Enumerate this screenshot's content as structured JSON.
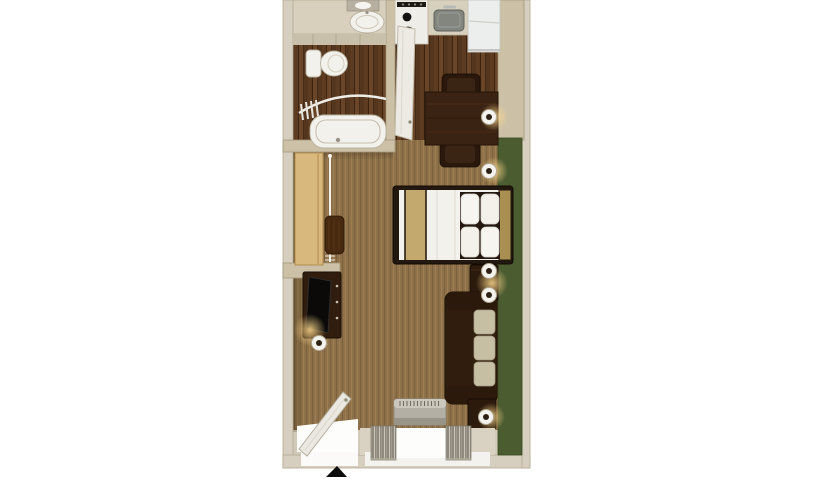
{
  "meta": {
    "type": "floor-plan",
    "view": "top-down-3d-render",
    "subject": "studio-suite-room-layout"
  },
  "rooms": {
    "bathroom": "bathroom",
    "kitchen": "kitchenette",
    "closet": "open-closet",
    "living_area": "combined-sleeping-living-area",
    "entry": "entry"
  },
  "furniture": {
    "vanity": "vanity-counter-with-sink",
    "mirror": "vanity-mirror",
    "toilet": "toilet",
    "bathtub": "bathtub-with-shower-curtain-rod",
    "bathroom_door": "open-bathroom-door",
    "stove": "two-burner-cooktop",
    "kitchen_sink": "kitchen-sink",
    "fridge": "refrigerator",
    "dining_table": "dining-table",
    "chair_top": "dining-chair",
    "chair_bottom": "dining-chair",
    "bed": "double-bed-with-pillows",
    "runner": "gold-bed-runner",
    "headboard": "wood-headboard",
    "nightstand": "nightstand",
    "sofa": "three-cushion-sofa",
    "end_table": "end-table",
    "dresser": "tv-dresser",
    "tv": "flat-television",
    "closet_shelf": "closet-shelf-unit",
    "closet_rod": "hanging-rod-with-hangers",
    "clothes": "hanging-clothes",
    "entry_door": "open-entry-door",
    "window": "window-with-drapes",
    "ac_unit": "ptac-air-conditioner",
    "wall_lamp": "wall-sconce-lamp",
    "table_lamp": "table-lamp"
  },
  "markers": {
    "entrance_arrow": "▲"
  },
  "palette": {
    "background": "#ffffff",
    "carpet": "#8e7148",
    "wood": "#5b3a21",
    "wall-outer": "#d6cfc0",
    "wall-inner": "#ccc1a7",
    "accent-green": "#4c5c31",
    "furniture-dark": "#33200f",
    "bed-white": "#f3f1ec",
    "runner-gold": "#c3a96e",
    "cushion-tan": "#c7bfa4",
    "lamp-glow": "#f5c77d",
    "arrow-black": "#0c0c0c"
  }
}
